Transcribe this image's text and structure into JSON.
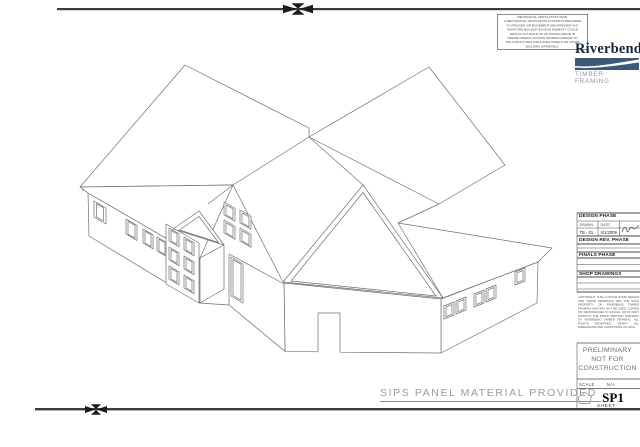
{
  "page": {
    "background": "#ffffff",
    "border_color": "#3d3d3d",
    "drawing_line_color": "#6f6f6f"
  },
  "top_note": {
    "lines": [
      "MECHANICAL VENTILATION NOTE:",
      "A MECHANICAL VENTILATION SYSTEM IS REQUIRED",
      "TO PROVIDE AIR MOVEMENT AND PREVENT ANY",
      "MOISTURE BUILDUP. EXCESS HUMIDITY COULD",
      "RESULT IN A BUILD UP OF WATER VAPOR IN",
      "HEATED AREAS CAUSING SEVERE DAMAGE TO",
      "THE STRUCTURAL INSULATED PANELS OR OTHER",
      "BUILDING MATERIALS."
    ]
  },
  "logo": {
    "name": "Riverbend",
    "tagline": "TIMBER FRAMING",
    "bar_color": "#3c5a77",
    "name_color": "#16293b",
    "tagline_color": "#8b97a6"
  },
  "title_block": {
    "phases": [
      {
        "title": "DESIGN PHASE"
      },
      {
        "title": "DESIGN REV. PHASE"
      },
      {
        "title": "FINALS PHASE"
      },
      {
        "title": "SHOP DRAWINGS"
      }
    ],
    "design_fields": {
      "drawn_label": "DRAWN",
      "drawn_value": "TB - 01",
      "date_label": "DATE",
      "date_value": "4/1/2009"
    },
    "legal": "COPYRIGHT. THIS CUSTOM HOME DESIGN AND THESE DRAWINGS ARE THE SOLE PROPERTY OF RIVERBEND TIMBER FRAMING AND MAY NOT BE USED, COPIED OR REPRODUCED IN WHOLE OR IN PART WITHOUT THE PRIOR WRITTEN CONSENT OF RIVERBEND TIMBER FRAMING. ALL RIGHTS RESERVED. VERIFY ALL DIMENSIONS AND CONDITIONS ON SITE.",
    "status": {
      "line1": "PRELIMINARY",
      "line2": "NOT FOR",
      "line3": "CONSTRUCTION"
    },
    "scale_label": "SCALE",
    "scale_value": "N/A",
    "sheet_number": "SP1",
    "sheet_label": "SHEET"
  },
  "drawing": {
    "caption": "SIPS PANEL MATERIAL PROVIDED",
    "subject": "isometric line drawing of SIPS panel house"
  }
}
